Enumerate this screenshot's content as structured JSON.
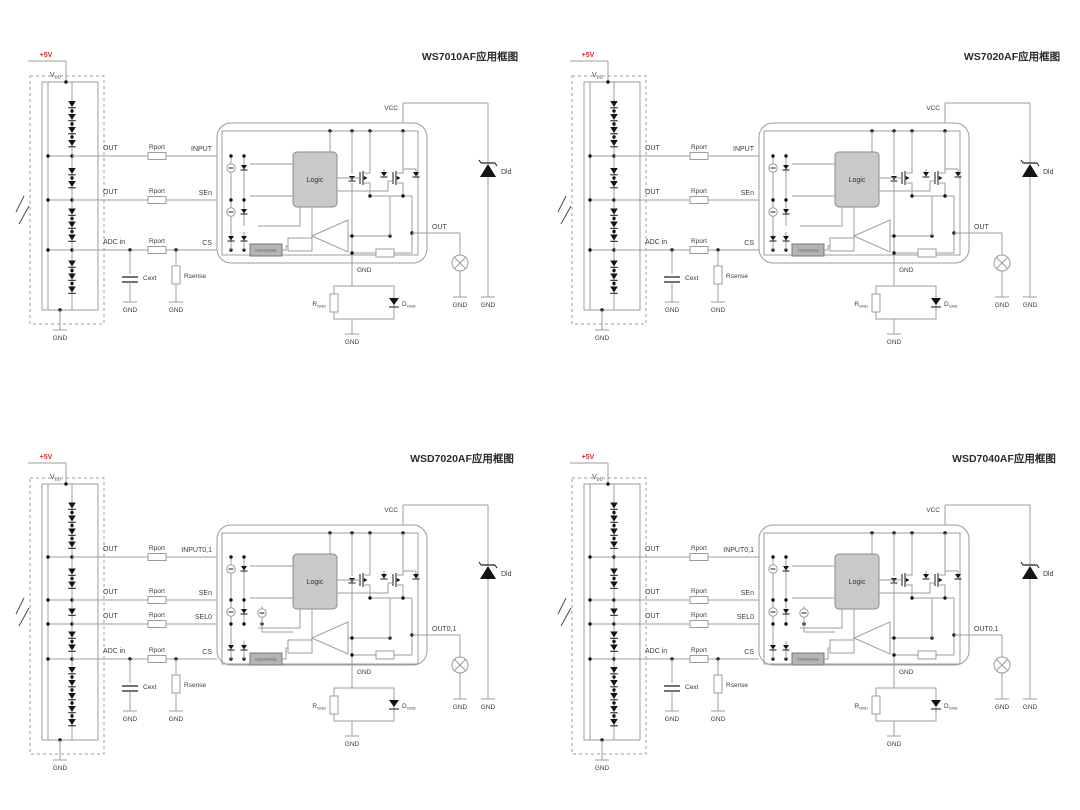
{
  "page": {
    "background": "#ffffff"
  },
  "colors": {
    "wire": "#9c9c9c",
    "text": "#3b3b3b",
    "dark": "#141414",
    "power_red": "#cc3326",
    "logic_fill": "#c9c9c9",
    "logic_stroke": "#8a8a8a",
    "sense_fill": "#b4b4b4",
    "sense_stroke": "#777777"
  },
  "shared_labels": {
    "power": "+5V",
    "vdd": {
      "main": "V",
      "sub": "DD"
    },
    "gnd": "GND",
    "vcc": "VCC",
    "logic": "Logic",
    "current_sense": "Current sense",
    "rport": "Rport",
    "cext": "Cext",
    "rsense": "Rsense",
    "cs": "CS",
    "rgnd": {
      "main": "R",
      "sub": "GND"
    },
    "dgnd": {
      "main": "D",
      "sub": "GND"
    },
    "dld": "Dld"
  },
  "diagrams": [
    {
      "id": "ws7010af",
      "title": "WS7010AF应用框图",
      "taps": [
        "OUT",
        "OUT",
        "ADC in"
      ],
      "pins": [
        "INPUT",
        "SEn",
        "CS"
      ],
      "out_label": "OUT"
    },
    {
      "id": "ws7020af",
      "title": "WS7020AF应用框图",
      "taps": [
        "OUT",
        "OUT",
        "ADC in"
      ],
      "pins": [
        "INPUT",
        "SEn",
        "CS"
      ],
      "out_label": "OUT"
    },
    {
      "id": "wsd7020af",
      "title": "WSD7020AF应用框图",
      "taps": [
        "OUT",
        "OUT",
        "OUT",
        "ADC in"
      ],
      "pins": [
        "INPUT0,1",
        "SEn",
        "SEL0",
        "CS"
      ],
      "out_label": "OUT0,1"
    },
    {
      "id": "wsd7040af",
      "title": "WSD7040AF应用框图",
      "taps": [
        "OUT",
        "OUT",
        "OUT",
        "ADC in"
      ],
      "pins": [
        "INPUT0,1",
        "SEn",
        "SEL0",
        "CS"
      ],
      "out_label": "OUT0,1"
    }
  ]
}
